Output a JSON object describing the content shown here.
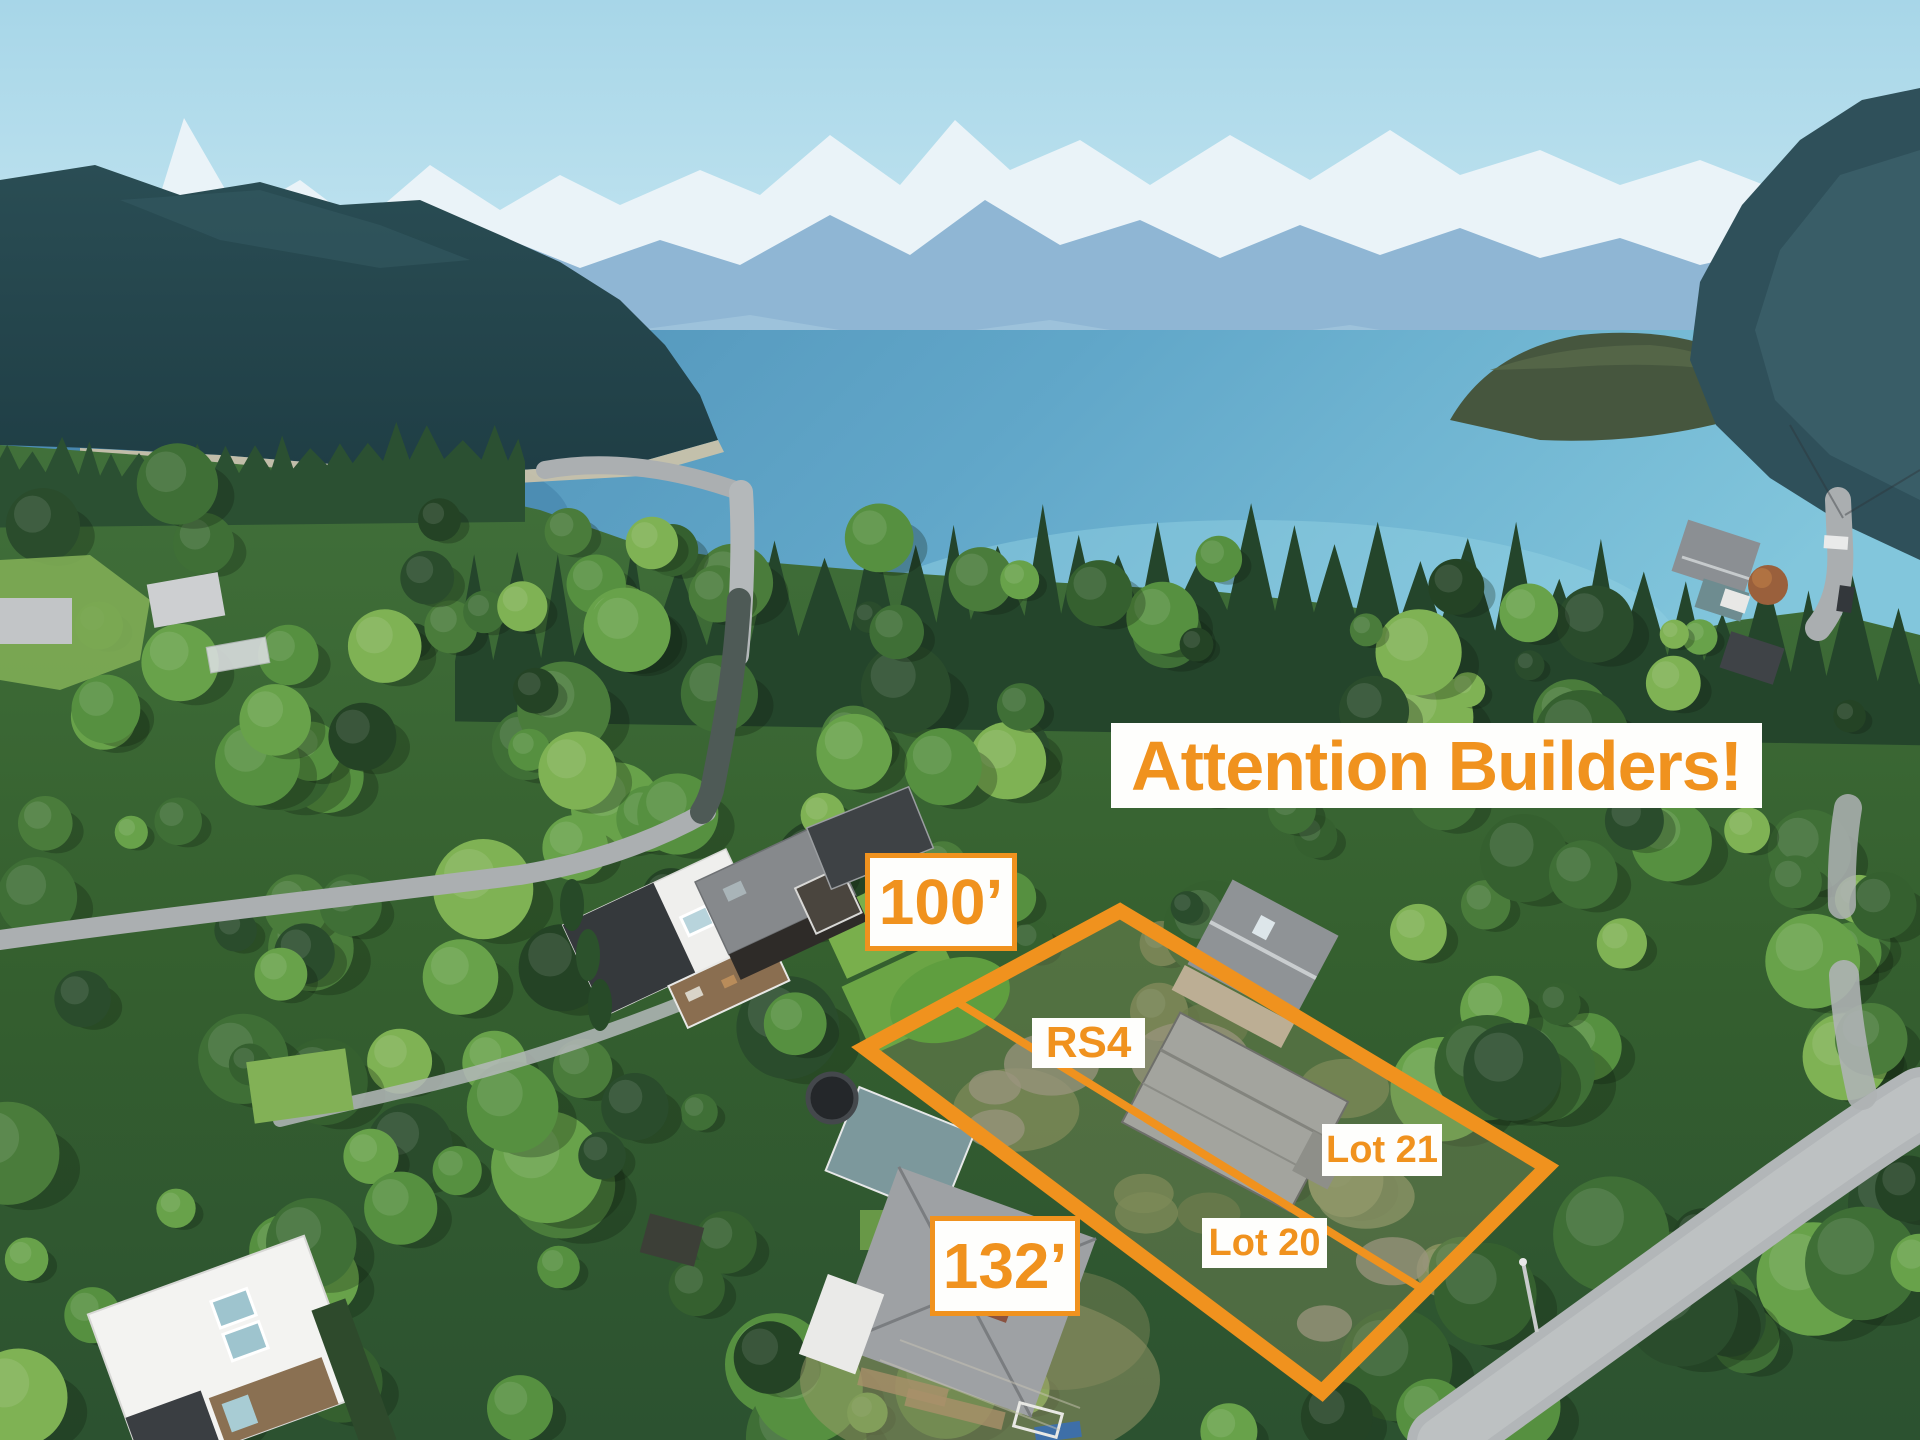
{
  "colors": {
    "annotation_orange": "#F0921E",
    "label_background": "#FFFFFF"
  },
  "overlay": {
    "headline": "Attention Builders!",
    "width_label": "100’",
    "length_label": "132’",
    "zoning_label": "RS4",
    "lots": [
      {
        "label": "Lot 21"
      },
      {
        "label": "Lot 20"
      }
    ]
  }
}
